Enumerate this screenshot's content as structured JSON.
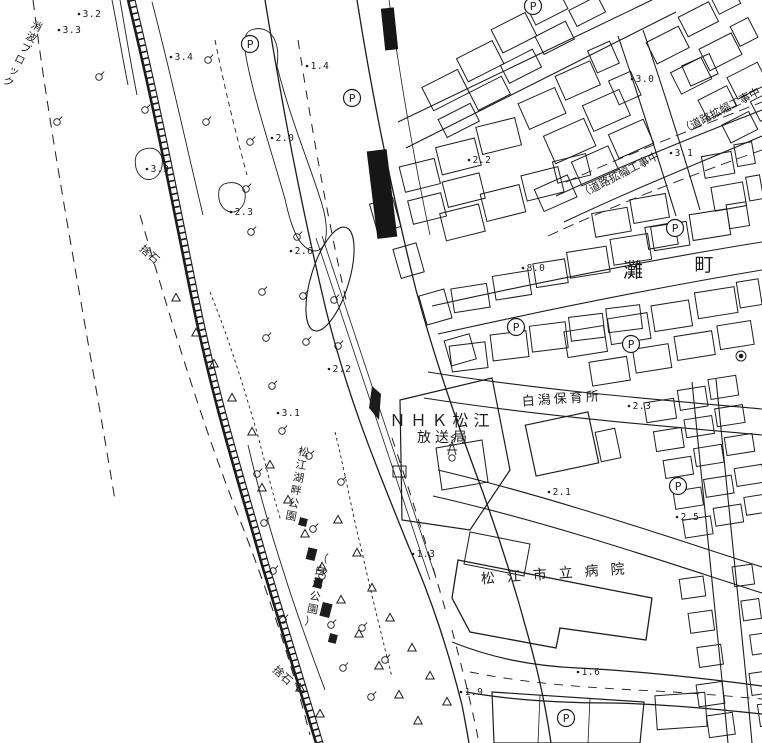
{
  "map": {
    "kind": "scanned city planning map (Matsue, Japan)",
    "colors": {
      "ink": "#1c1c1c",
      "paper": "#ffffff"
    },
    "labels": [
      {
        "id": "breakwater-blocks",
        "text": "消波ブロック",
        "x": 40,
        "y": 20,
        "size": 10.5,
        "rotate": 27,
        "vertical": true
      },
      {
        "id": "riprap-upper",
        "text": "捨石",
        "x": 147,
        "y": 257,
        "size": 11,
        "rotate": 42
      },
      {
        "id": "riprap-lower",
        "text": "捨石",
        "x": 280,
        "y": 678,
        "size": 11,
        "rotate": 42
      },
      {
        "id": "kohan-park",
        "text": "松江湖畔公園",
        "x": 305,
        "y": 445,
        "size": 11,
        "rotate": 11,
        "vertical": true
      },
      {
        "id": "shiragata-park",
        "text": "（白潟公園）",
        "x": 324,
        "y": 551,
        "size": 11,
        "rotate": 11,
        "vertical": true
      },
      {
        "id": "nhk-line1",
        "text": "ＮＨＫ松江",
        "x": 442,
        "y": 426,
        "size": 16,
        "spacing": 5
      },
      {
        "id": "nhk-line2",
        "text": "放送局",
        "x": 444,
        "y": 442,
        "size": 14,
        "spacing": 4
      },
      {
        "id": "nursery-school",
        "text": "白潟保育所",
        "x": 562,
        "y": 403,
        "size": 13,
        "spacing": 3,
        "rotate": -4
      },
      {
        "id": "city-hospital",
        "text": "松江市立病院",
        "x": 559,
        "y": 578,
        "size": 14,
        "spacing": 12,
        "rotate": -4
      },
      {
        "id": "district-nada",
        "text": "灘",
        "x": 633,
        "y": 277,
        "size": 20
      },
      {
        "id": "district-machi",
        "text": "町",
        "x": 704,
        "y": 271,
        "size": 19
      },
      {
        "id": "roadwork-upper",
        "text": "（道路拡幅工事中",
        "x": 722,
        "y": 114,
        "size": 11,
        "rotate": -27
      },
      {
        "id": "roadwork-lower",
        "text": "（道路拡幅工事中",
        "x": 621,
        "y": 178,
        "size": 11,
        "rotate": -27
      }
    ],
    "spot_elevations": [
      {
        "v": "3.2",
        "x": 92,
        "y": 17
      },
      {
        "v": "3.3",
        "x": 72,
        "y": 33
      },
      {
        "v": "3.4",
        "x": 184,
        "y": 60
      },
      {
        "v": "1.4",
        "x": 320,
        "y": 69
      },
      {
        "v": "2.0",
        "x": 285,
        "y": 141
      },
      {
        "v": "3.3",
        "x": 160,
        "y": 172
      },
      {
        "v": "2.3",
        "x": 244,
        "y": 215
      },
      {
        "v": "2.6",
        "x": 304,
        "y": 254
      },
      {
        "v": "2.2",
        "x": 482,
        "y": 163
      },
      {
        "v": "3.0",
        "x": 645,
        "y": 82
      },
      {
        "v": "3.1",
        "x": 684,
        "y": 156
      },
      {
        "v": "8.0",
        "x": 536,
        "y": 271
      },
      {
        "v": "2.2",
        "x": 342,
        "y": 372
      },
      {
        "v": "3.1",
        "x": 291,
        "y": 416
      },
      {
        "v": "2.3",
        "x": 642,
        "y": 409
      },
      {
        "v": "2.1",
        "x": 562,
        "y": 495
      },
      {
        "v": "2.5",
        "x": 690,
        "y": 520
      },
      {
        "v": "1.3",
        "x": 426,
        "y": 557
      },
      {
        "v": "1.9",
        "x": 474,
        "y": 695
      },
      {
        "v": "1.6",
        "x": 591,
        "y": 675
      }
    ],
    "parking": {
      "symbol": "P",
      "positions": [
        [
          250,
          44
        ],
        [
          352,
          98
        ],
        [
          533,
          6
        ],
        [
          675,
          228
        ],
        [
          516,
          327
        ],
        [
          631,
          344
        ],
        [
          678,
          486
        ],
        [
          566,
          718
        ]
      ]
    },
    "vegetation": {
      "tree_symbol": "shrub-circle",
      "trees": [
        [
          57,
          122
        ],
        [
          99,
          77
        ],
        [
          145,
          110
        ],
        [
          206,
          122
        ],
        [
          246,
          189
        ],
        [
          251,
          232
        ],
        [
          297,
          237
        ],
        [
          262,
          292
        ],
        [
          303,
          296
        ],
        [
          334,
          300
        ],
        [
          266,
          338
        ],
        [
          306,
          342
        ],
        [
          338,
          346
        ],
        [
          272,
          386
        ],
        [
          282,
          431
        ],
        [
          257,
          474
        ],
        [
          309,
          456
        ],
        [
          341,
          482
        ],
        [
          264,
          523
        ],
        [
          313,
          529
        ],
        [
          273,
          571
        ],
        [
          322,
          576
        ],
        [
          283,
          620
        ],
        [
          331,
          625
        ],
        [
          362,
          628
        ],
        [
          343,
          668
        ],
        [
          385,
          660
        ],
        [
          371,
          697
        ],
        [
          250,
          142
        ],
        [
          208,
          60
        ]
      ],
      "slope_symbol": "open-triangle",
      "slope_marks": [
        [
          176,
          298
        ],
        [
          196,
          333
        ],
        [
          214,
          364
        ],
        [
          232,
          398
        ],
        [
          252,
          432
        ],
        [
          270,
          465
        ],
        [
          288,
          500
        ],
        [
          305,
          534
        ],
        [
          322,
          567
        ],
        [
          341,
          600
        ],
        [
          359,
          634
        ],
        [
          379,
          666
        ],
        [
          399,
          695
        ],
        [
          418,
          721
        ],
        [
          300,
          688
        ],
        [
          320,
          714
        ],
        [
          357,
          553
        ],
        [
          372,
          588
        ],
        [
          390,
          618
        ],
        [
          412,
          648
        ],
        [
          430,
          676
        ],
        [
          447,
          702
        ],
        [
          262,
          488
        ],
        [
          338,
          520
        ]
      ]
    },
    "point_symbols": {
      "radio_tower": [
        452,
        452
      ],
      "monument_circle": [
        741,
        356
      ]
    }
  }
}
